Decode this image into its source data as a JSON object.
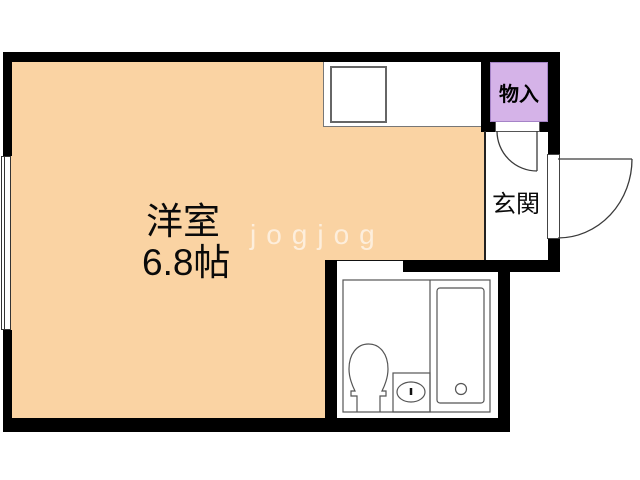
{
  "main_room": {
    "name": "洋室",
    "size": "6.8帖"
  },
  "entrance": {
    "label": "玄関"
  },
  "storage": {
    "label": "物入"
  },
  "watermark": {
    "text": "jogjog"
  },
  "fixtures": [
    "kitchen-sink",
    "toilet",
    "washbasin",
    "bathtub"
  ],
  "colors": {
    "room_fill": "#FAD3A3",
    "storage_fill": "#D5B3E8",
    "storage_border": "#A583C7",
    "wall": "#000000",
    "watermark": "rgba(255,255,255,0.62)"
  }
}
